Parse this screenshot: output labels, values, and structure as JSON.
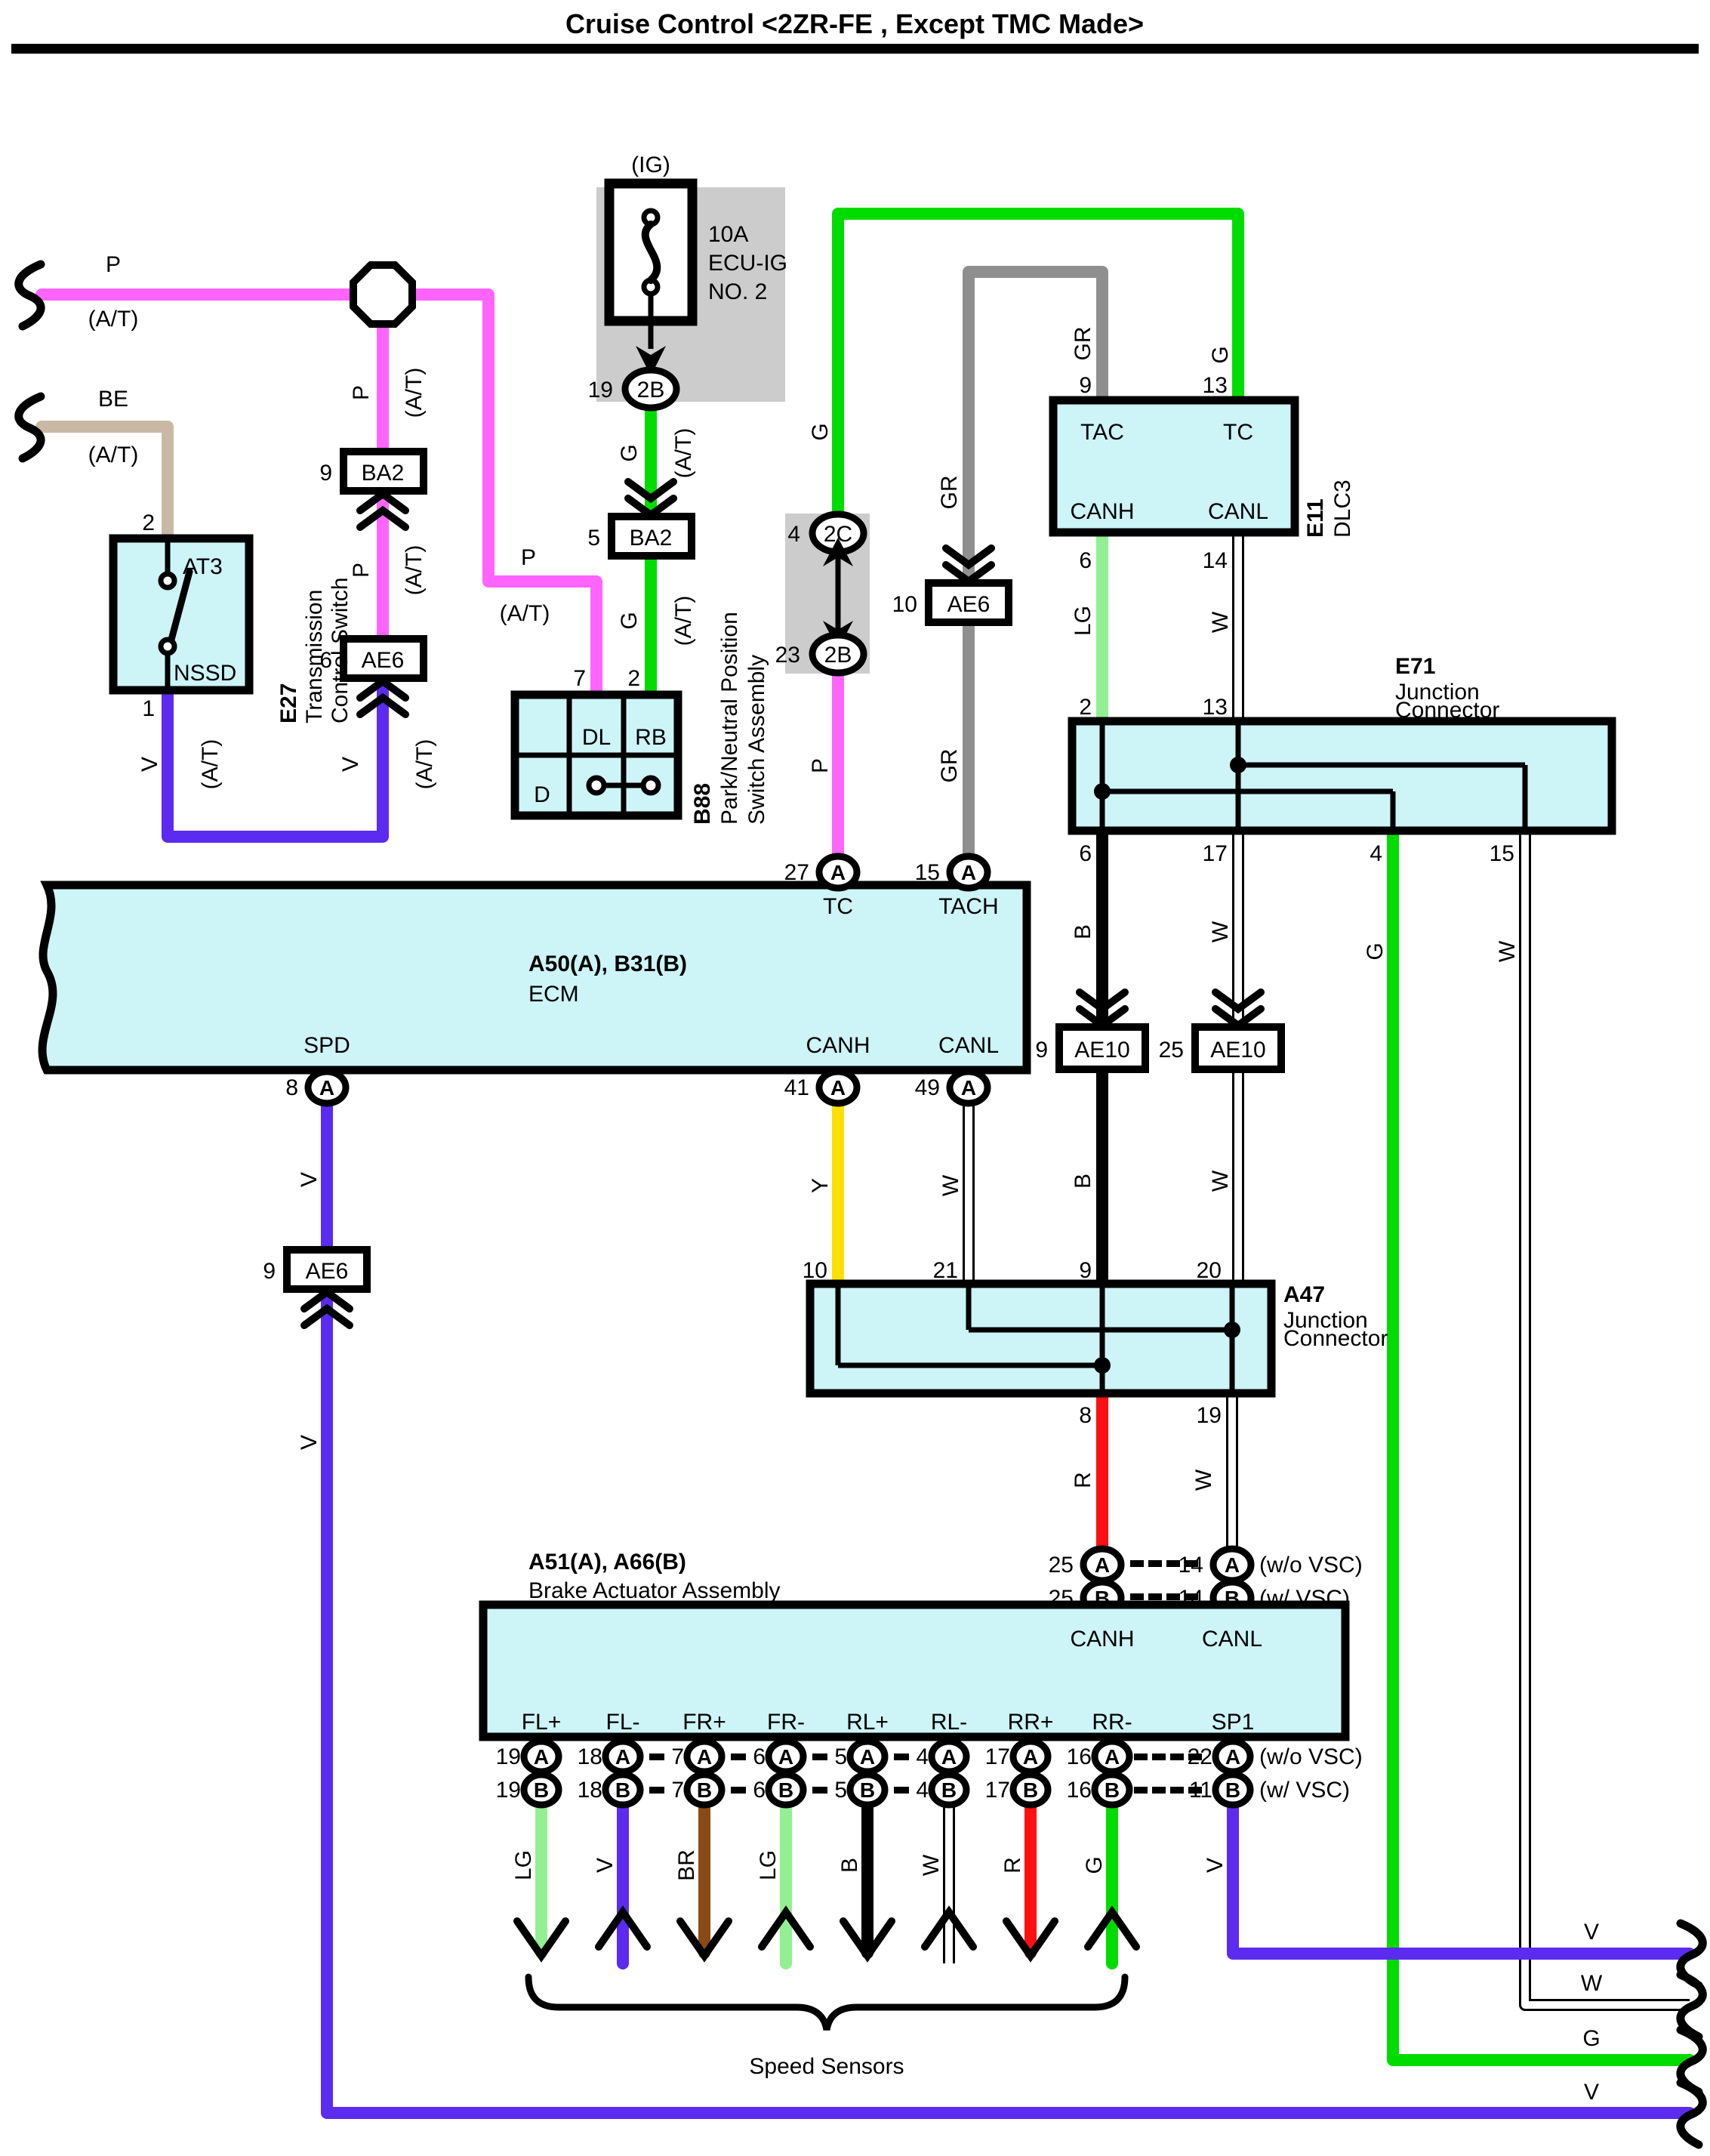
{
  "title": "Cruise Control <2ZR-FE , Except TMC Made>",
  "palette": {
    "pink": "#FF64FF",
    "violet": "#5B2BF0",
    "tan": "#C9B9A4",
    "green": "#00DC00",
    "light_green": "#92EF92",
    "gray_wire": "#8F8F8F",
    "yellow": "#FFE000",
    "red": "#FF0F0F",
    "brown": "#8A4A16",
    "black": "#000000",
    "white": "#FFFFFF",
    "component_fill": "#CDF4F6",
    "shade_fill": "#CCCCCC"
  },
  "fuse": {
    "ig_label": "(IG)",
    "rating": "10A",
    "name_line1": "ECU-IG",
    "name_line2": "NO. 2",
    "pin": "19",
    "connector": "2B"
  },
  "pw": {
    "left_code": "P",
    "left_suffix": "(A/T)",
    "mid_code": "P",
    "mid_suffix": "(A/T)",
    "up_code": "P",
    "up_suffix": "(A/T)",
    "low_code": "P",
    "low_suffix": "(A/T)",
    "tc_code": "P"
  },
  "be": {
    "code": "BE",
    "suffix": "(A/T)"
  },
  "tcs": {
    "id": "E27",
    "name_line1": "Transmission",
    "name_line2": "Control Switch",
    "contact_top": "AT3",
    "contact_bottom": "NSSD",
    "pin_top": "2",
    "pin_bottom": "1",
    "v_left_code": "V",
    "v_left_suffix": "(A/T)",
    "v_right_code": "V",
    "v_right_suffix": "(A/T)"
  },
  "conn": {
    "ba2_9": {
      "pin": "9",
      "label": "BA2"
    },
    "ae6_6": {
      "pin": "6",
      "label": "AE6"
    },
    "ba2_5": {
      "pin": "5",
      "label": "BA2"
    },
    "ae6_10": {
      "pin": "10",
      "label": "AE6"
    },
    "ae6_9": {
      "pin": "9",
      "label": "AE6"
    },
    "ae10_9": {
      "pin": "9",
      "label": "AE10"
    },
    "ae10_25": {
      "pin": "25",
      "label": "AE10"
    }
  },
  "gw": {
    "fuse_up_code": "G",
    "fuse_up_suffix": "(A/T)",
    "fuse_low_code": "G",
    "fuse_low_suffix": "(A/T)",
    "ig2c_code": "G",
    "tc_code": "G"
  },
  "b88": {
    "id": "B88",
    "name_line1": "Park/Neutral Position",
    "name_line2": "Switch Assembly",
    "cell_dl": "DL",
    "cell_rb": "RB",
    "cell_d": "D",
    "pin_dl": "7",
    "pin_rb": "2"
  },
  "igsw": {
    "pin_2c": "4",
    "conn_2c": "2C",
    "pin_2b": "23",
    "conn_2b": "2B"
  },
  "grw": {
    "left_up": "GR",
    "left_low": "GR",
    "right": "GR"
  },
  "dlc3": {
    "id": "E11",
    "name": "DLC3",
    "tac": "TAC",
    "tc": "TC",
    "canh": "CANH",
    "canl": "CANL",
    "pin_tac": "9",
    "pin_tc": "13",
    "pin_canh": "6",
    "pin_canl": "14"
  },
  "canw": {
    "lg": "LG",
    "w1": "W",
    "b1": "B",
    "b2": "B",
    "w2": "W",
    "w3": "W",
    "y": "Y",
    "w4": "W",
    "r": "R",
    "w5": "W",
    "g_long": "G",
    "w_long": "W"
  },
  "e71": {
    "id": "E71",
    "name_line1": "Junction",
    "name_line2": "Connector",
    "pin_t2": "2",
    "pin_t13": "13",
    "pin_b6": "6",
    "pin_b17": "17",
    "pin_b4": "4",
    "pin_b15": "15"
  },
  "ecm": {
    "id": "A50(A), B31(B)",
    "name": "ECM",
    "tc": "TC",
    "tach": "TACH",
    "spd": "SPD",
    "canh": "CANH",
    "canl": "CANL",
    "pin_tc": "27",
    "pin_tach": "15",
    "pin_spd": "8",
    "pin_canh": "41",
    "pin_canl": "49",
    "letter": "A"
  },
  "a47": {
    "id": "A47",
    "name_line1": "Junction",
    "name_line2": "Connector",
    "pin_t10": "10",
    "pin_t21": "21",
    "pin_t9": "9",
    "pin_t20": "20",
    "pin_b8": "8",
    "pin_b19": "19"
  },
  "vspd": {
    "v1": "V",
    "v2": "V"
  },
  "brake": {
    "id": "A51(A), A66(B)",
    "name": "Brake Actuator Assembly",
    "canh": "CANH",
    "canl": "CANL",
    "letter_a": "A",
    "letter_b": "B",
    "pin_canh_a": "25",
    "pin_canh_b": "25",
    "pin_canl_a": "14",
    "pin_canl_b": "14",
    "wo_vsc_top": "(w/o VSC)",
    "w_vsc_top": "(w/ VSC)",
    "wo_vsc_bottom": "(w/o VSC)",
    "w_vsc_bottom": "(w/ VSC)",
    "channels": [
      {
        "label": "FL+",
        "a": "19",
        "b": "19",
        "color": "LG"
      },
      {
        "label": "FL-",
        "a": "18",
        "b": "18",
        "color": "V"
      },
      {
        "label": "FR+",
        "a": "7",
        "b": "7",
        "color": "BR"
      },
      {
        "label": "FR-",
        "a": "6",
        "b": "6",
        "color": "LG"
      },
      {
        "label": "RL+",
        "a": "5",
        "b": "5",
        "color": "B"
      },
      {
        "label": "RL-",
        "a": "4",
        "b": "4",
        "color": "W"
      },
      {
        "label": "RR+",
        "a": "17",
        "b": "17",
        "color": "R"
      },
      {
        "label": "RR-",
        "a": "16",
        "b": "16",
        "color": "G"
      },
      {
        "label": "SP1",
        "a": "22",
        "b": "11",
        "color": "V"
      }
    ],
    "brace_label": "Speed Sensors"
  },
  "bottom_right": {
    "v1": "V",
    "w": "W",
    "g": "G",
    "v2": "V"
  }
}
